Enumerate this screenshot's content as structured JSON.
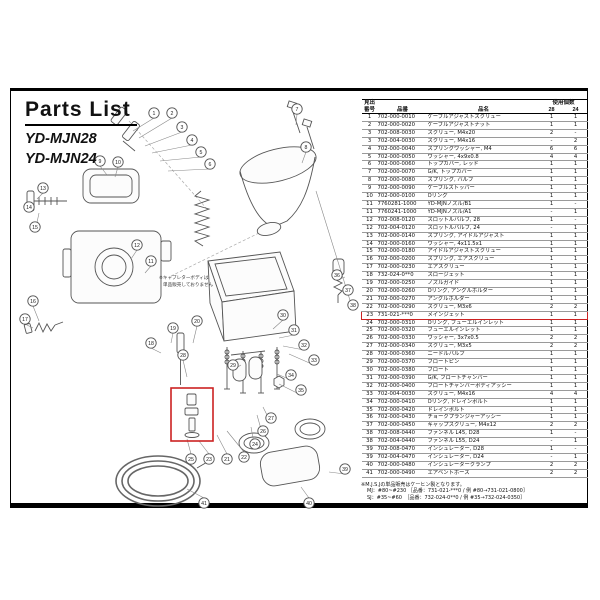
{
  "header": {
    "title": "Parts List",
    "models": [
      "YD-MJN28",
      "YD-MJN24"
    ]
  },
  "colors": {
    "highlight_red": "#cc2222",
    "line_gray": "#555555"
  },
  "diagram": {
    "note_line1": "※キャブレターボディは",
    "note_line2": "単品販売しておりません",
    "balloons": [
      {
        "n": "1",
        "x": 143,
        "y": 22
      },
      {
        "n": "2",
        "x": 161,
        "y": 22
      },
      {
        "n": "3",
        "x": 171,
        "y": 36
      },
      {
        "n": "4",
        "x": 181,
        "y": 49
      },
      {
        "n": "5",
        "x": 190,
        "y": 61
      },
      {
        "n": "6",
        "x": 199,
        "y": 73
      },
      {
        "n": "7",
        "x": 286,
        "y": 18
      },
      {
        "n": "8",
        "x": 295,
        "y": 56
      },
      {
        "n": "9",
        "x": 89,
        "y": 70
      },
      {
        "n": "10",
        "x": 107,
        "y": 71
      },
      {
        "n": "11",
        "x": 140,
        "y": 170
      },
      {
        "n": "12",
        "x": 126,
        "y": 154
      },
      {
        "n": "13",
        "x": 32,
        "y": 97
      },
      {
        "n": "14",
        "x": 18,
        "y": 116
      },
      {
        "n": "15",
        "x": 24,
        "y": 136
      },
      {
        "n": "16",
        "x": 22,
        "y": 210
      },
      {
        "n": "17",
        "x": 14,
        "y": 228
      },
      {
        "n": "18",
        "x": 140,
        "y": 252
      },
      {
        "n": "19",
        "x": 162,
        "y": 237
      },
      {
        "n": "20",
        "x": 186,
        "y": 230
      },
      {
        "n": "25",
        "x": 180,
        "y": 368
      },
      {
        "n": "23",
        "x": 198,
        "y": 368
      },
      {
        "n": "21",
        "x": 216,
        "y": 368
      },
      {
        "n": "22",
        "x": 233,
        "y": 366
      },
      {
        "n": "24",
        "x": 244,
        "y": 353
      },
      {
        "n": "26",
        "x": 252,
        "y": 340
      },
      {
        "n": "27",
        "x": 260,
        "y": 327
      },
      {
        "n": "28",
        "x": 172,
        "y": 264
      },
      {
        "n": "29",
        "x": 222,
        "y": 274
      },
      {
        "n": "30",
        "x": 272,
        "y": 224
      },
      {
        "n": "31",
        "x": 283,
        "y": 239
      },
      {
        "n": "32",
        "x": 293,
        "y": 254
      },
      {
        "n": "33",
        "x": 303,
        "y": 269
      },
      {
        "n": "34",
        "x": 280,
        "y": 284
      },
      {
        "n": "35",
        "x": 290,
        "y": 299
      },
      {
        "n": "36",
        "x": 326,
        "y": 184
      },
      {
        "n": "37",
        "x": 337,
        "y": 199
      },
      {
        "n": "38",
        "x": 342,
        "y": 214
      },
      {
        "n": "39",
        "x": 334,
        "y": 378
      },
      {
        "n": "40",
        "x": 298,
        "y": 412
      },
      {
        "n": "41",
        "x": 193,
        "y": 412
      }
    ]
  },
  "table": {
    "headers": {
      "no_line1": "見出",
      "no_line2": "番号",
      "part_no": "品番",
      "name": "品名",
      "qty": "使用個数",
      "qty_28": "28",
      "qty_24": "24"
    },
    "rows": [
      {
        "no": "1",
        "pn": "702-000-0010",
        "name": "ケーブルアジャストスクリュー",
        "q28": "1",
        "q24": "1"
      },
      {
        "no": "2",
        "pn": "702-000-0020",
        "name": "ケーブルアジャストナット",
        "q28": "1",
        "q24": "1"
      },
      {
        "no": "3",
        "pn": "702-008-0030",
        "name": "スクリュー, M4x20",
        "q28": "2",
        "q24": "-"
      },
      {
        "no": "3",
        "pn": "702-004-0030",
        "name": "スクリュー, M4x16",
        "q28": "-",
        "q24": "2"
      },
      {
        "no": "4",
        "pn": "702-000-0040",
        "name": "スプリングワッシャー, M4",
        "q28": "6",
        "q24": "6"
      },
      {
        "no": "5",
        "pn": "702-000-0050",
        "name": "ワッシャー, 4x9x0.8",
        "q28": "4",
        "q24": "4"
      },
      {
        "no": "6",
        "pn": "702-000-0060",
        "name": "トップカバー, レッド",
        "q28": "1",
        "q24": "1"
      },
      {
        "no": "7",
        "pn": "702-000-0070",
        "name": "G/K, トップカバー",
        "q28": "1",
        "q24": "1"
      },
      {
        "no": "8",
        "pn": "702-000-0080",
        "name": "スプリング, バルブ",
        "q28": "1",
        "q24": "1"
      },
      {
        "no": "9",
        "pn": "702-000-0090",
        "name": "ケーブルストッパー",
        "q28": "1",
        "q24": "1"
      },
      {
        "no": "10",
        "pn": "702-000-0100",
        "name": "Oリング",
        "q28": "1",
        "q24": "1"
      },
      {
        "no": "11",
        "pn": "7760281-1000",
        "name": "YD-MJNノズル/B1",
        "q28": "1",
        "q24": "-"
      },
      {
        "no": "11",
        "pn": "7760241-1000",
        "name": "YD-MJNノズル/A1",
        "q28": "-",
        "q24": "1"
      },
      {
        "no": "12",
        "pn": "702-008-0120",
        "name": "スロットルバルブ, 28",
        "q28": "1",
        "q24": "-"
      },
      {
        "no": "12",
        "pn": "702-004-0120",
        "name": "スロットルバルブ, 24",
        "q28": "-",
        "q24": "1"
      },
      {
        "no": "13",
        "pn": "702-000-0140",
        "name": "スプリング, アイドルアジャスト",
        "q28": "1",
        "q24": "1"
      },
      {
        "no": "14",
        "pn": "702-000-0160",
        "name": "ワッシャー, 4x11.5x1",
        "q28": "1",
        "q24": "1"
      },
      {
        "no": "15",
        "pn": "702-000-0180",
        "name": "アイドルアジャストスクリュー",
        "q28": "1",
        "q24": "1"
      },
      {
        "no": "16",
        "pn": "702-000-0200",
        "name": "スプリング, エアスクリュー",
        "q28": "1",
        "q24": "1"
      },
      {
        "no": "17",
        "pn": "702-000-0230",
        "name": "エアスクリュー",
        "q28": "1",
        "q24": "1"
      },
      {
        "no": "18",
        "pn": "732-024-0**0",
        "name": "スロージェット",
        "q28": "1",
        "q24": "1"
      },
      {
        "no": "19",
        "pn": "702-000-0250",
        "name": "ノズルガイド",
        "q28": "1",
        "q24": "1"
      },
      {
        "no": "20",
        "pn": "702-000-0260",
        "name": "Oリング, アングルホルダー",
        "q28": "1",
        "q24": "1"
      },
      {
        "no": "21",
        "pn": "702-000-0270",
        "name": "アングルホルダー",
        "q28": "1",
        "q24": "1"
      },
      {
        "no": "22",
        "pn": "702-000-0290",
        "name": "スクリュー, M3x6",
        "q28": "2",
        "q24": "2"
      },
      {
        "no": "23",
        "pn": "731-021-***0",
        "name": "メインジェット",
        "q28": "1",
        "q24": "1",
        "highlight": true
      },
      {
        "no": "24",
        "pn": "702-000-0310",
        "name": "Oリング, フューエルインレット",
        "q28": "1",
        "q24": "1"
      },
      {
        "no": "25",
        "pn": "702-000-0320",
        "name": "フューエルインレット",
        "q28": "1",
        "q24": "1"
      },
      {
        "no": "26",
        "pn": "702-000-0330",
        "name": "ワッシャー, 3x7x0.5",
        "q28": "2",
        "q24": "2"
      },
      {
        "no": "27",
        "pn": "702-000-0340",
        "name": "スクリュー, M3x5",
        "q28": "2",
        "q24": "2"
      },
      {
        "no": "28",
        "pn": "702-000-0360",
        "name": "ニードルバルブ",
        "q28": "1",
        "q24": "1"
      },
      {
        "no": "29",
        "pn": "702-000-0370",
        "name": "フロートピン",
        "q28": "1",
        "q24": "1"
      },
      {
        "no": "30",
        "pn": "702-000-0380",
        "name": "フロート",
        "q28": "1",
        "q24": "1"
      },
      {
        "no": "31",
        "pn": "702-000-0390",
        "name": "G/K, フロートチャンバー",
        "q28": "1",
        "q24": "1"
      },
      {
        "no": "32",
        "pn": "702-000-0400",
        "name": "フロートチャンバーボディアッシー",
        "q28": "1",
        "q24": "1"
      },
      {
        "no": "33",
        "pn": "702-004-0030",
        "name": "スクリュー, M4x16",
        "q28": "4",
        "q24": "4"
      },
      {
        "no": "34",
        "pn": "702-000-0410",
        "name": "Oリング, ドレインボルト",
        "q28": "1",
        "q24": "1"
      },
      {
        "no": "35",
        "pn": "702-000-0420",
        "name": "ドレインボルト",
        "q28": "1",
        "q24": "1"
      },
      {
        "no": "36",
        "pn": "702-000-0430",
        "name": "チョークプランジャーアッシー",
        "q28": "1",
        "q24": "1"
      },
      {
        "no": "37",
        "pn": "702-000-0450",
        "name": "キャップスクリュー, M4x12",
        "q28": "2",
        "q24": "2"
      },
      {
        "no": "38",
        "pn": "702-008-0440",
        "name": "ファンネル L45, D28",
        "q28": "1",
        "q24": "-"
      },
      {
        "no": "38",
        "pn": "702-004-0440",
        "name": "ファンネル L55, D24",
        "q28": "-",
        "q24": "1"
      },
      {
        "no": "39",
        "pn": "702-008-0470",
        "name": "インシュレーター, D28",
        "q28": "1",
        "q24": "-"
      },
      {
        "no": "39",
        "pn": "702-004-0470",
        "name": "インシュレーター, D24",
        "q28": "-",
        "q24": "1"
      },
      {
        "no": "40",
        "pn": "702-000-0480",
        "name": "インシュレータークランプ",
        "q28": "2",
        "q24": "2"
      },
      {
        "no": "41",
        "pn": "702-000-0490",
        "name": "エアベントホース",
        "q28": "2",
        "q24": "2"
      }
    ]
  },
  "footnote": {
    "lines": [
      "※M.J.S.Jの単品販売はケーヒン製となります。",
      "MJ：#80~#230 ［品番：731-021-***0 / 例 #80→731-021-0800］",
      "SJ：#35~#60　［品番：732-024-0**0 / 例 #35→732-024-0350］"
    ]
  }
}
